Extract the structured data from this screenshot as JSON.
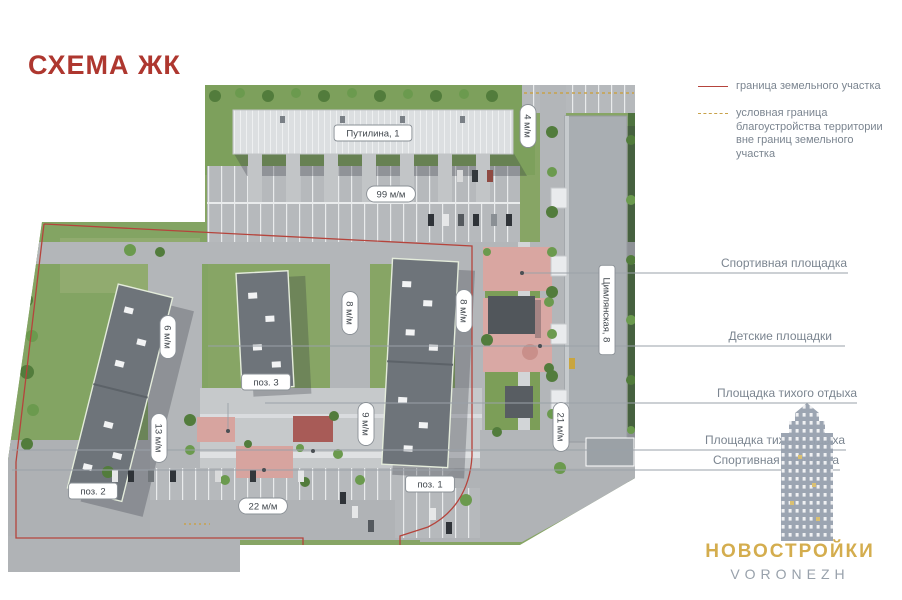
{
  "page": {
    "title": "СХЕМА ЖК"
  },
  "legend": {
    "items": [
      {
        "label": "граница земельного участка",
        "style": "solid",
        "color": "#b5443c"
      },
      {
        "label": "условная граница благоустройства территории вне границ земельного участка",
        "style": "dashed",
        "color": "#c8a24a"
      }
    ]
  },
  "callouts": [
    {
      "label": "Спортивная площадка"
    },
    {
      "label": "Детские площадки"
    },
    {
      "label": "Площадка тихого отдыха"
    },
    {
      "label": "Площадка тихого отдыха"
    },
    {
      "label": "Спортивная площадка"
    }
  ],
  "map": {
    "badges": [
      {
        "label": "Путилина, 1",
        "x": 373,
        "y": 133,
        "rot": 0,
        "kind": "address"
      },
      {
        "label": "Цимлянская, 8",
        "x": 607,
        "y": 310,
        "rot": 90,
        "kind": "address"
      },
      {
        "label": "99 м/м",
        "x": 391,
        "y": 194,
        "rot": 0,
        "kind": "distance"
      },
      {
        "label": "4 м/м",
        "x": 528,
        "y": 126,
        "rot": 90,
        "kind": "distance"
      },
      {
        "label": "6 м/м",
        "x": 168,
        "y": 337,
        "rot": 90,
        "kind": "distance"
      },
      {
        "label": "8 м/м",
        "x": 350,
        "y": 313,
        "rot": 90,
        "kind": "distance"
      },
      {
        "label": "8 м/м",
        "x": 464,
        "y": 311,
        "rot": 90,
        "kind": "distance"
      },
      {
        "label": "9 м/м",
        "x": 366,
        "y": 424,
        "rot": 90,
        "kind": "distance"
      },
      {
        "label": "13 м/м",
        "x": 159,
        "y": 438,
        "rot": 90,
        "kind": "distance"
      },
      {
        "label": "21 м/м",
        "x": 561,
        "y": 427,
        "rot": 90,
        "kind": "distance"
      },
      {
        "label": "22 м/м",
        "x": 263,
        "y": 506,
        "rot": 0,
        "kind": "distance"
      },
      {
        "label": "поз. 3",
        "x": 266,
        "y": 382,
        "rot": 0,
        "kind": "position"
      },
      {
        "label": "поз. 2",
        "x": 93,
        "y": 491,
        "rot": 0,
        "kind": "position"
      },
      {
        "label": "поз. 1",
        "x": 430,
        "y": 484,
        "rot": 0,
        "kind": "position"
      }
    ]
  },
  "watermark": {
    "brand": "НОВОСТРОЙКИ",
    "city": "VORONEZH"
  }
}
